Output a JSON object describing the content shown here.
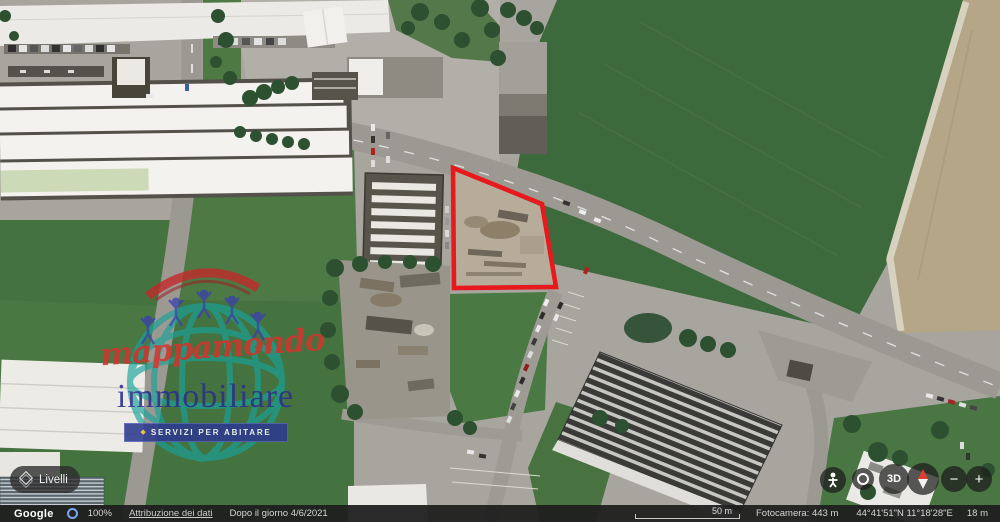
{
  "map": {
    "type": "satellite-imagery",
    "parcel_outline": {
      "points": "453,168 542,204 556,287 454,288",
      "color": "#e8191d",
      "stroke_width": 4.6
    }
  },
  "watermark": {
    "brand_script": "mappamondo",
    "brand_serif": "immobiliare",
    "tagline": "SERVIZI PER ABITARE",
    "diamond_glyph": "◆",
    "colors": {
      "script": "#cf3630",
      "serif": "#2b2f8c",
      "band_bg": "#2c3b8e",
      "globe": "#17a39a",
      "roof": "#c2282c",
      "figures": "#3b40b0"
    }
  },
  "layers_panel": {
    "label": "Livelli",
    "icon": "layers-diamond-icon"
  },
  "map_controls": {
    "pegman_icon": "pegman-icon",
    "my_location_icon": "crosshair-icon",
    "view_3d_label": "3D",
    "compass_icon": "compass-needle-icon",
    "zoom_out_label": "−",
    "zoom_in_label": "+"
  },
  "status_bar": {
    "google_logo": "Google",
    "loading_icon": "loading-ring-icon",
    "zoom_percent": "100%",
    "attribution_link": "Attribuzione dei dati",
    "imagery_date": "Dopo il giorno 4/6/2021",
    "scale_label": "50 m",
    "camera_altitude": "Fotocamera: 443 m",
    "coordinates": "44°41'51\"N 11°18'28\"E",
    "elevation": "18 m",
    "bar_color": "#1e1e1e"
  }
}
